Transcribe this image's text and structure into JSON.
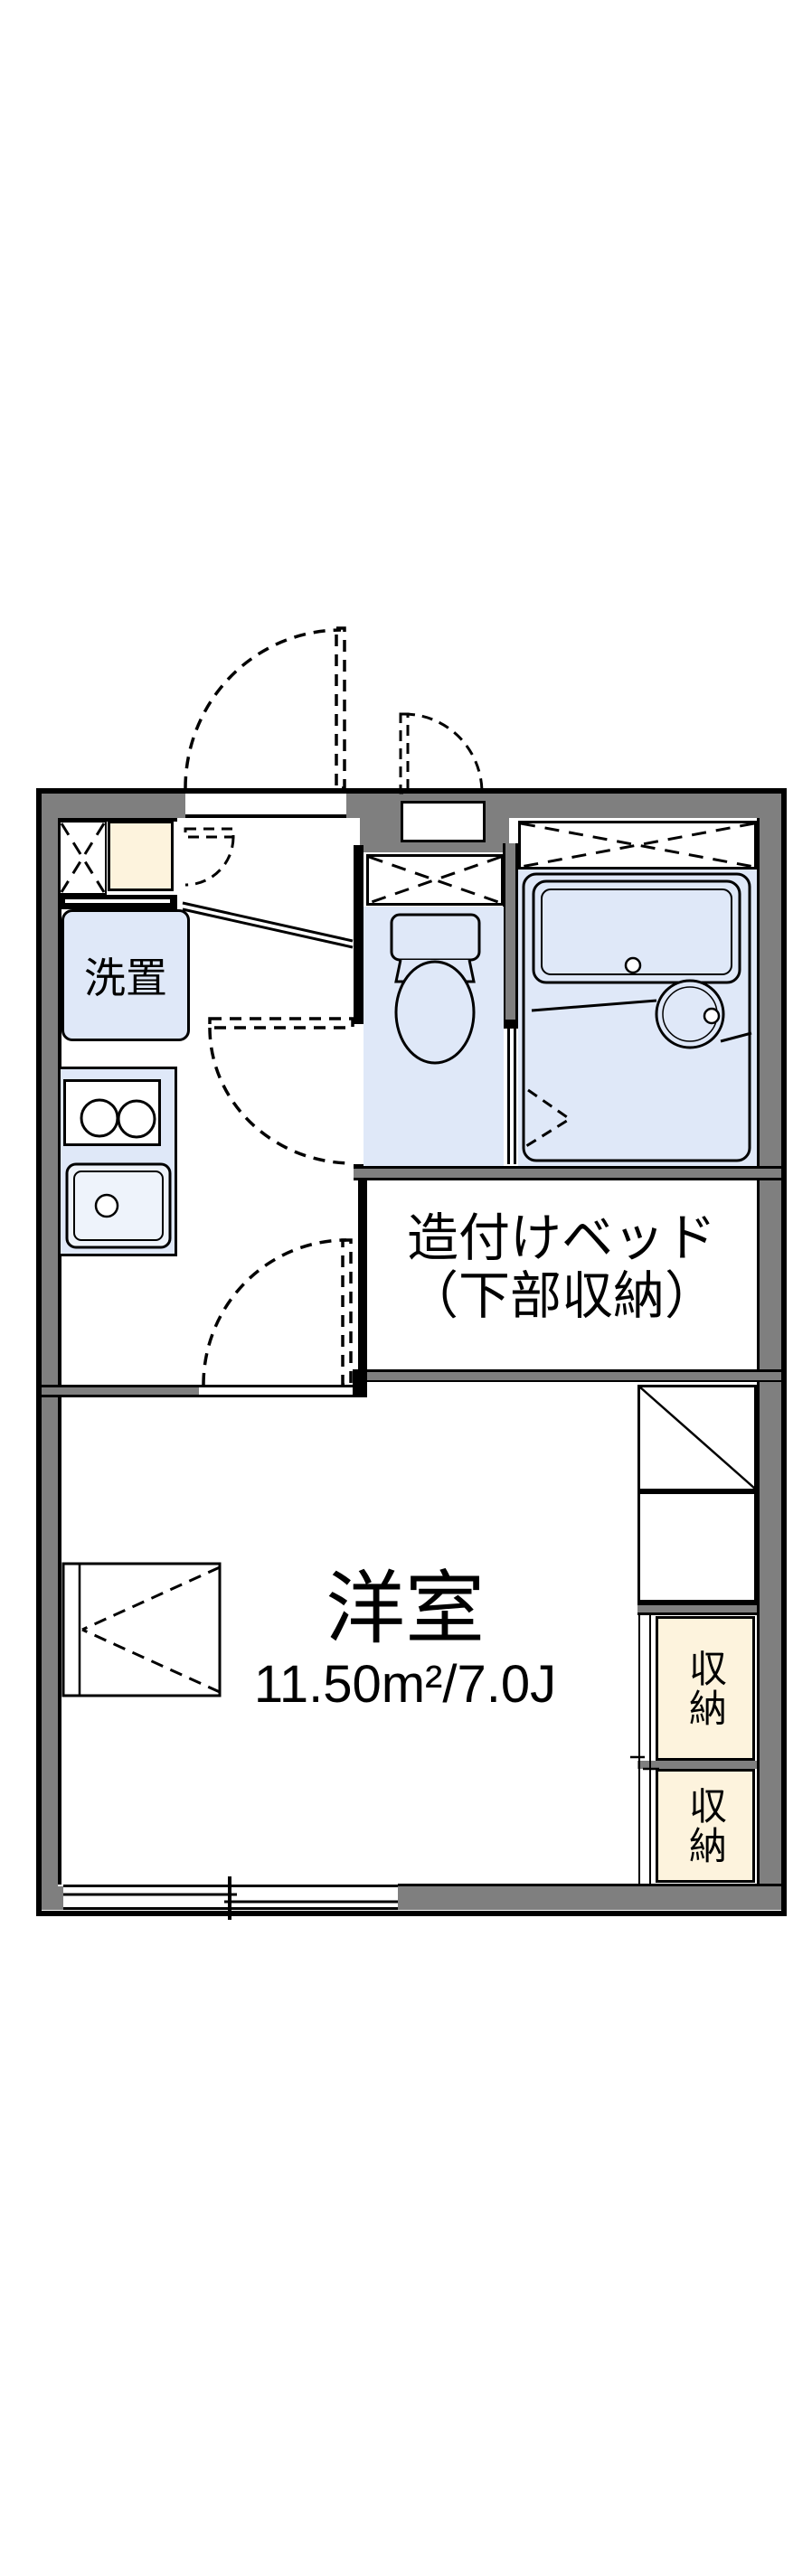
{
  "floorplan": {
    "rooms": {
      "laundry_label": "洗置",
      "bed_label_line1": "造付けベッド",
      "bed_label_line2": "（下部収納）",
      "main_room_name": "洋室",
      "main_room_area": "11.50m²/7.0J",
      "storage_upper": "収納",
      "storage_lower": "収納"
    },
    "colors": {
      "wall_gray": "#7f7f7f",
      "fixture_blue": "#dfe8f8",
      "storage_cream": "#fdf3dd",
      "line_black": "#000000",
      "background": "#ffffff"
    }
  }
}
